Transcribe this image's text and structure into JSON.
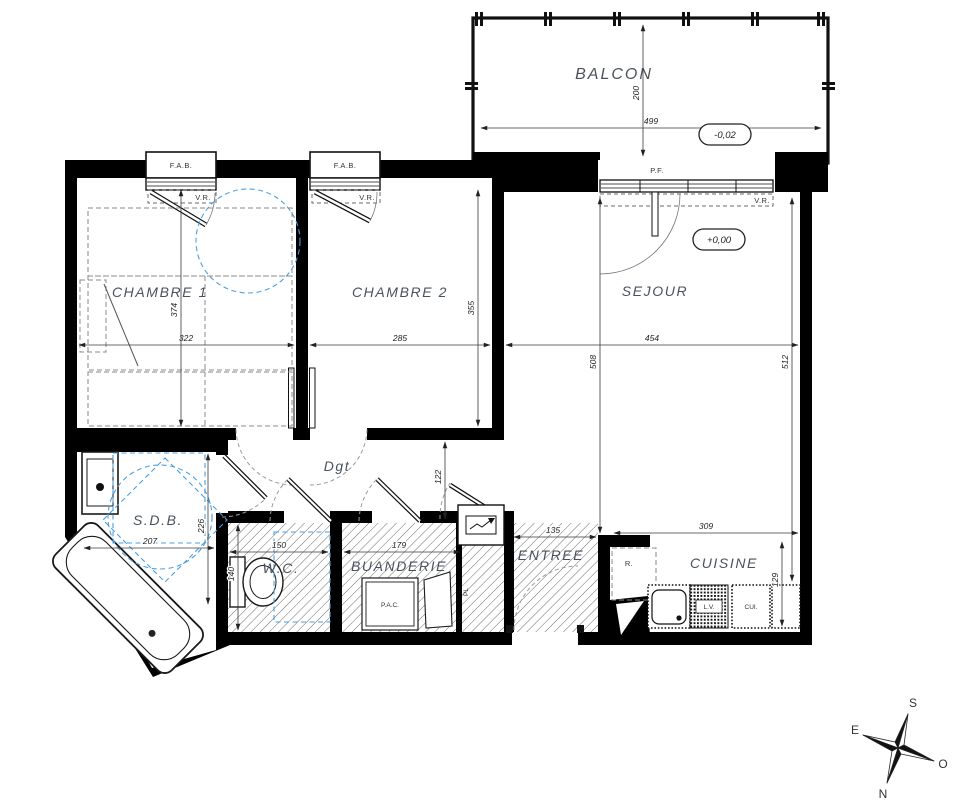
{
  "rooms": {
    "balcon": "BALCON",
    "chambre1": "CHAMBRE 1",
    "chambre2": "CHAMBRE 2",
    "sejour": "SEJOUR",
    "sdb": "S.D.B.",
    "wc": "W.C.",
    "buanderie": "BUANDERIE",
    "entree": "ENTREE",
    "cuisine": "CUISINE",
    "degagement": "Dgt"
  },
  "levels": {
    "balcony_level": "-0,02",
    "floor_level": "+0,00"
  },
  "openings": {
    "fab": "F.A.B.",
    "pf": "P.F.",
    "vr": "V.R."
  },
  "equipment": {
    "pac": "P.A.C.",
    "fridge": "R.",
    "dishwasher": "L.V.",
    "cooker": "CUI.",
    "closet": "PL"
  },
  "dimensions": {
    "balcon_w": "499",
    "balcon_d": "200",
    "chambre1_w": "322",
    "chambre1_d": "374",
    "chambre2_w": "285",
    "chambre2_d": "355",
    "sejour_w": "454",
    "sejour_d_left": "508",
    "sejour_d_right": "512",
    "sdb_w": "207",
    "sdb_d": "226",
    "wc_w": "150",
    "wc_d": "140",
    "buanderie_w": "179",
    "entree_w": "135",
    "degagement_d": "122",
    "cuisine_w": "309",
    "cuisine_d": "129"
  },
  "compass": {
    "n": "N",
    "s": "S",
    "e": "E",
    "o": "O"
  },
  "colors": {
    "wall": "#000000",
    "accessibility": "#4a9fe0",
    "label": "#49525c"
  }
}
